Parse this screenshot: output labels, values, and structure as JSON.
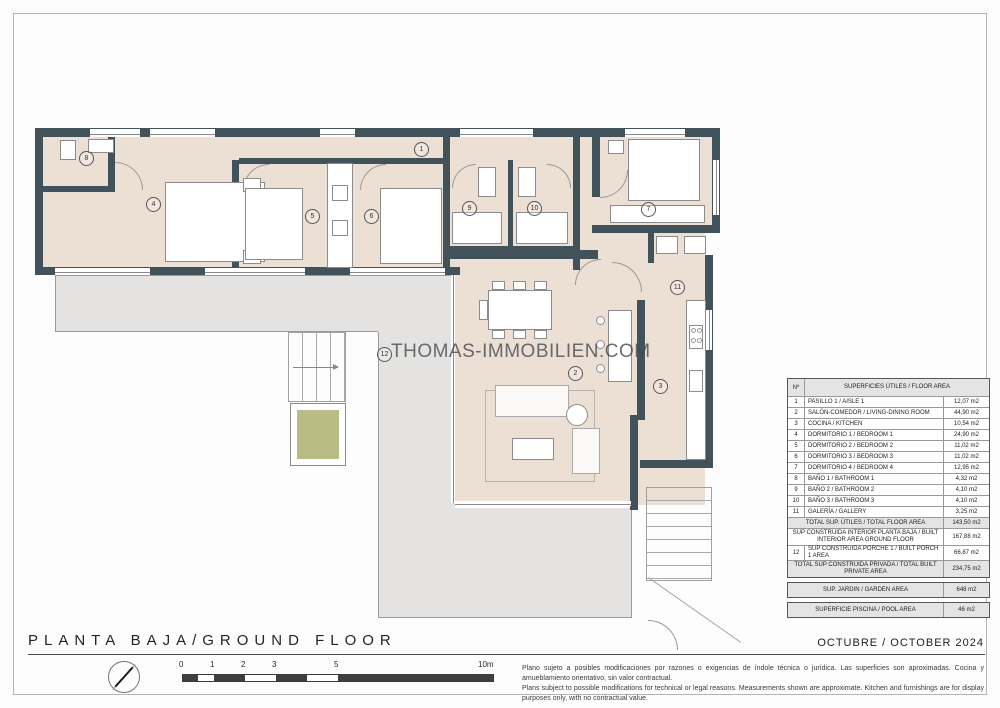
{
  "page": {
    "title": "PLANTA BAJA/GROUND FLOOR",
    "date": "OCTUBRE / OCTOBER 2024",
    "watermark": "THOMAS-IMMOBILIEN.COM",
    "disclaimer_es": "Plano sujeto a posibles modificaciones por razones o exigencias de índole técnica o jurídica. Las superficies son aproximadas. Cocina y amueblamiento orientativo, sin valor contractual.",
    "disclaimer_en": "Plans subject to possible modifications for technical or legal reasons. Measurements shown are approximate. Kitchen and furnishings are for display purposes only, with no contractual value."
  },
  "colors": {
    "wall": "#42525b",
    "floor": "#ecdfd3",
    "porch": "#e4e3e1",
    "planter": "#b9bc85"
  },
  "scalebar": {
    "labels": [
      "0",
      "1",
      "2",
      "3",
      "5",
      "10m"
    ]
  },
  "plan": {
    "labels": [
      {
        "num": "1"
      },
      {
        "num": "2"
      },
      {
        "num": "3"
      },
      {
        "num": "4"
      },
      {
        "num": "5"
      },
      {
        "num": "6"
      },
      {
        "num": "7"
      },
      {
        "num": "8"
      },
      {
        "num": "9"
      },
      {
        "num": "10"
      },
      {
        "num": "11"
      },
      {
        "num": "12"
      }
    ]
  },
  "area_table": {
    "header": {
      "num": "Nº",
      "label": "SUPERFICIES ÚTILES / FLOOR AREA"
    },
    "rows": [
      {
        "num": "1",
        "label": "PASILLO 1 / AISLE 1",
        "value": "12,07 m2"
      },
      {
        "num": "2",
        "label": "SALÓN-COMEDOR / LIVING-DINING ROOM",
        "value": "44,90 m2"
      },
      {
        "num": "3",
        "label": "COCINA / KITCHEN",
        "value": "10,54 m2"
      },
      {
        "num": "4",
        "label": "DORMITORIO 1 / BEDROOM 1",
        "value": "24,90 m2"
      },
      {
        "num": "5",
        "label": "DORMITORIO 2 / BEDROOM 2",
        "value": "11,02 m2"
      },
      {
        "num": "6",
        "label": "DORMITORIO 3 / BEDROOM 3",
        "value": "11,02 m2"
      },
      {
        "num": "7",
        "label": "DORMITORIO 4 / BEDROOM 4",
        "value": "12,95 m2"
      },
      {
        "num": "8",
        "label": "BAÑO 1 / BATHROOM 1",
        "value": "4,32 m2"
      },
      {
        "num": "9",
        "label": "BAÑO 2 / BATHROOM 2",
        "value": "4,10 m2"
      },
      {
        "num": "10",
        "label": "BAÑO 3 / BATHROOM 3",
        "value": "4,10 m2"
      },
      {
        "num": "11",
        "label": "GALERÍA / GALLERY",
        "value": "3,25 m2"
      }
    ],
    "summary": {
      "total_util": {
        "label": "TOTAL SUP. ÚTILES / TOTAL FLOOR AREA",
        "value": "143,50 m2"
      },
      "built_interior": {
        "label": "SUP CONSTRUIDA INTERIOR PLANTA BAJA / BUILT INTERIOR AREA GROUND FLOOR",
        "value": "167,88 m2"
      },
      "porch": {
        "num": "12",
        "label": "SUP CONSTRUIDA PORCHE 1 / BUILT PORCH 1 AREA",
        "value": "66,87 m2"
      },
      "total_private": {
        "label": "TOTAL SUP CONSTRUIDA PRIVADA / TOTAL BUILT PRIVATE AREA",
        "value": "234,75 m2"
      },
      "garden": {
        "label": "SUP. JARDIN / GARDEN AREA",
        "value": "648 m2"
      },
      "pool": {
        "label": "SUPERFICIE PISCINA / POOL AREA",
        "value": "46 m2"
      }
    }
  }
}
